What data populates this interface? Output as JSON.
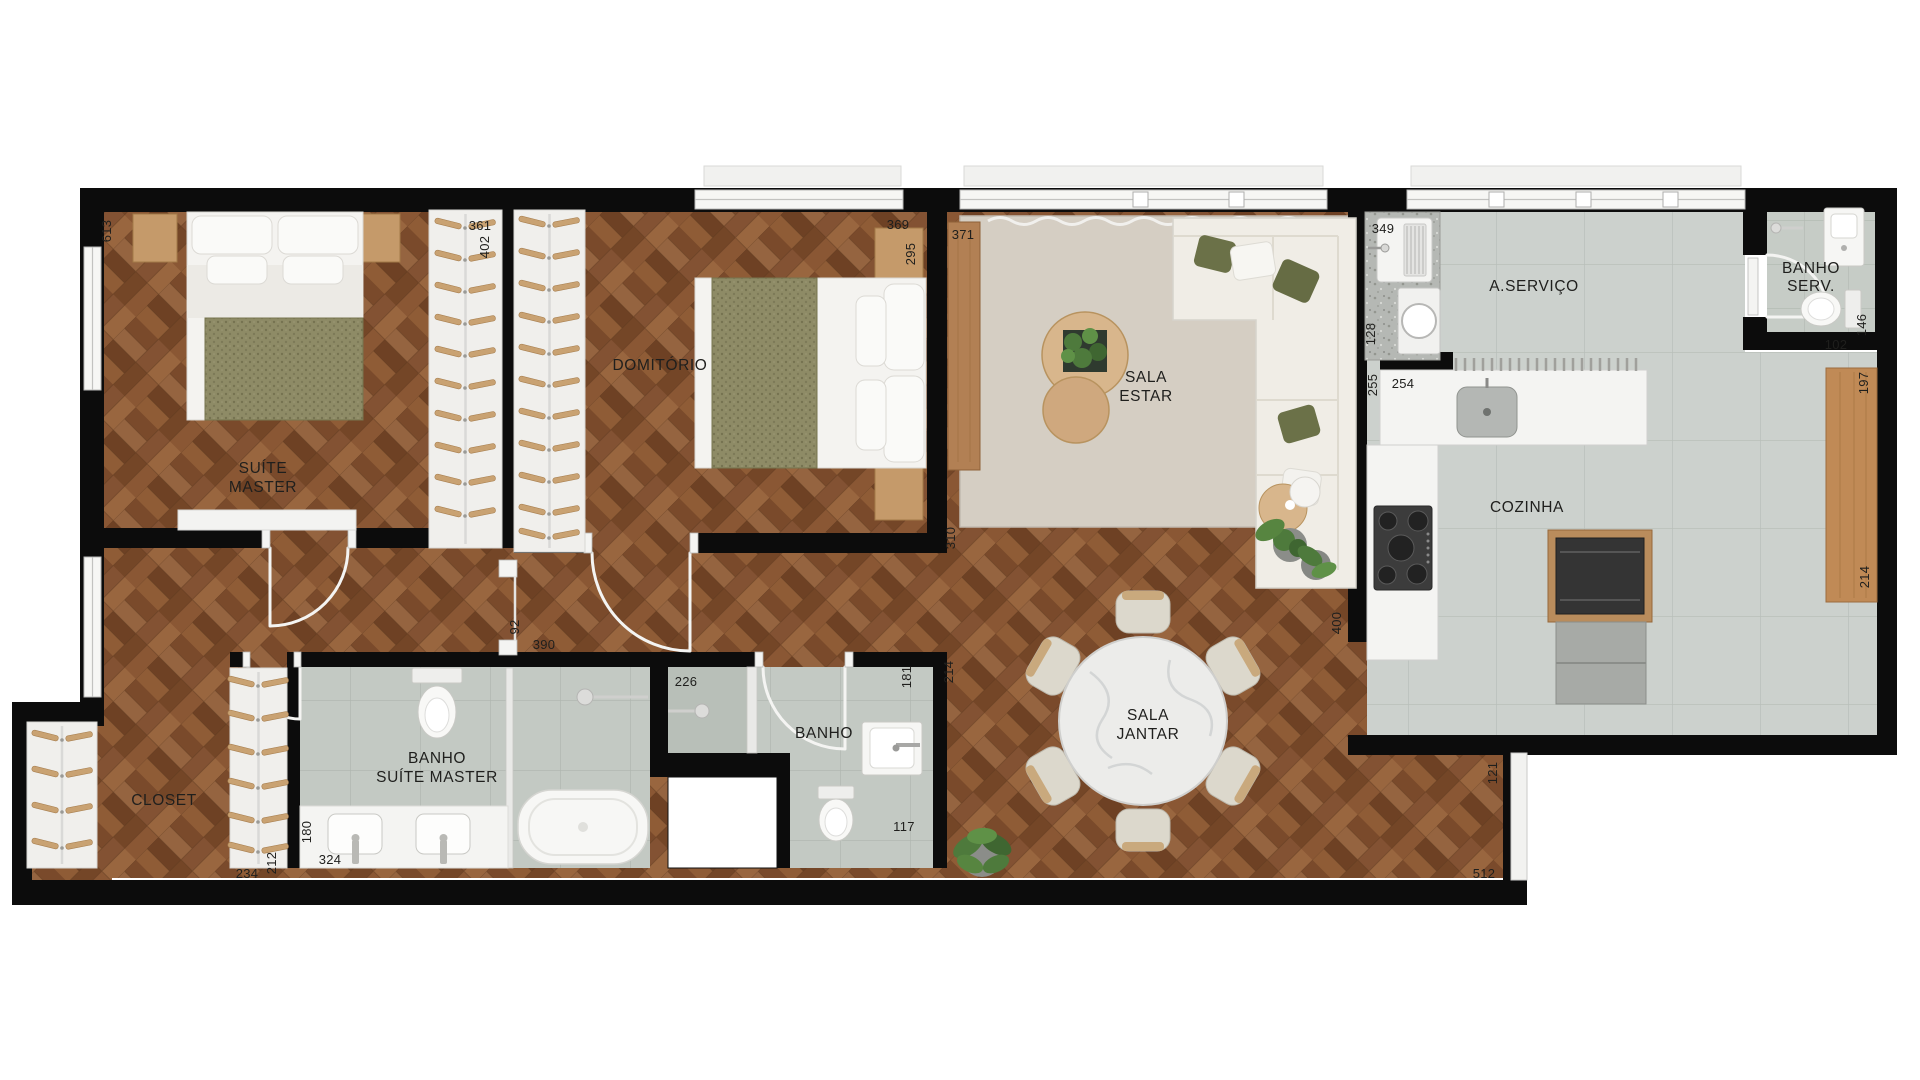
{
  "plan": {
    "type": "apartment-floor-plan",
    "rooms": [
      {
        "id": "suite-master",
        "lines": [
          "SUÍTE",
          "MASTER"
        ]
      },
      {
        "id": "domitorio",
        "lines": [
          "DOMITÓRIO"
        ]
      },
      {
        "id": "sala-estar",
        "lines": [
          "SALA",
          "ESTAR"
        ]
      },
      {
        "id": "a-servico",
        "lines": [
          "A.SERVIÇO"
        ]
      },
      {
        "id": "banho-serv",
        "lines": [
          "BANHO",
          "SERV."
        ]
      },
      {
        "id": "cozinha",
        "lines": [
          "COZINHA"
        ]
      },
      {
        "id": "sala-jantar",
        "lines": [
          "SALA",
          "JANTAR"
        ]
      },
      {
        "id": "banho",
        "lines": [
          "BANHO"
        ]
      },
      {
        "id": "banho-suite-master",
        "lines": [
          "BANHO",
          "SUÍTE MASTER"
        ]
      },
      {
        "id": "closet",
        "lines": [
          "CLOSET"
        ]
      }
    ],
    "dimensions": [
      {
        "value": "613"
      },
      {
        "value": "361"
      },
      {
        "value": "402"
      },
      {
        "value": "369"
      },
      {
        "value": "295"
      },
      {
        "value": "371"
      },
      {
        "value": "349"
      },
      {
        "value": "128"
      },
      {
        "value": "255"
      },
      {
        "value": "254"
      },
      {
        "value": "102"
      },
      {
        "value": "146"
      },
      {
        "value": "197"
      },
      {
        "value": "214"
      },
      {
        "value": "92"
      },
      {
        "value": "390"
      },
      {
        "value": "310"
      },
      {
        "value": "214"
      },
      {
        "value": "226"
      },
      {
        "value": "181"
      },
      {
        "value": "117"
      },
      {
        "value": "180"
      },
      {
        "value": "324"
      },
      {
        "value": "234"
      },
      {
        "value": "212"
      },
      {
        "value": "400"
      },
      {
        "value": "121"
      },
      {
        "value": "512"
      }
    ],
    "colors": {
      "wall": "#0c0c0c",
      "wood_floor": "#8a5a38",
      "tile_kitchen": "#ccd1cd",
      "tile_bath": "#c3c9c3",
      "rug": "#d5cec3",
      "sofa": "#f0ede6",
      "olive_accent": "#6b7148",
      "wood_furniture": "#c59a6a",
      "marble": "#ececea",
      "counter_white": "#f4f4f2",
      "appliance_dark": "#343434"
    }
  }
}
